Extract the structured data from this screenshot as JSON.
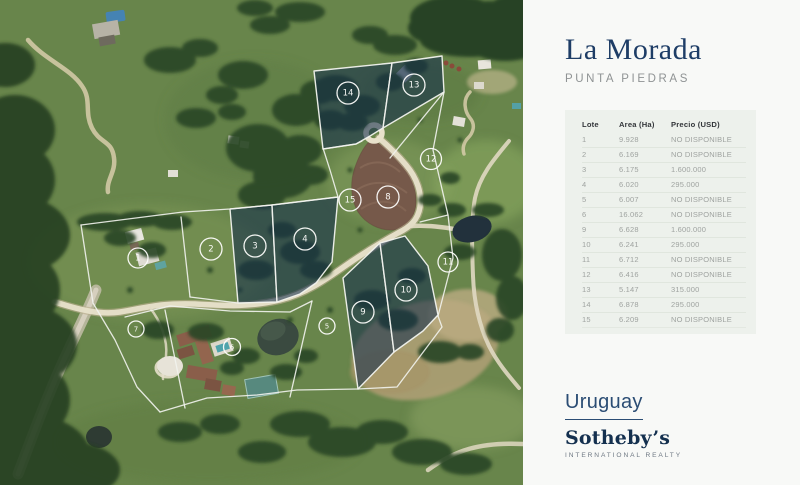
{
  "header": {
    "title": "La Morada",
    "subtitle": "PUNTA  PIEDRAS"
  },
  "table": {
    "columns": [
      "Lote",
      "Area (Ha)",
      "Precio (USD)"
    ],
    "rows": [
      [
        "1",
        "9.928",
        "NO DISPONIBLE"
      ],
      [
        "2",
        "6.169",
        "NO DISPONIBLE"
      ],
      [
        "3",
        "6.175",
        "1.600.000"
      ],
      [
        "4",
        "6.020",
        "295.000"
      ],
      [
        "5",
        "6.007",
        "NO DISPONIBLE"
      ],
      [
        "6",
        "16.062",
        "NO DISPONIBLE"
      ],
      [
        "9",
        "6.628",
        "1.600.000"
      ],
      [
        "10",
        "6.241",
        "295.000"
      ],
      [
        "11",
        "6.712",
        "NO DISPONIBLE"
      ],
      [
        "12",
        "6.416",
        "NO DISPONIBLE"
      ],
      [
        "13",
        "5.147",
        "315.000"
      ],
      [
        "14",
        "6.878",
        "295.000"
      ],
      [
        "15",
        "6.209",
        "NO DISPONIBLE"
      ]
    ]
  },
  "brand": {
    "country": "Uruguay",
    "name": "Sotheby’s",
    "tagline": "INTERNATIONAL REALTY"
  },
  "map": {
    "lots": [
      {
        "n": "1",
        "x": 138,
        "y": 258,
        "r": 10,
        "filled": false
      },
      {
        "n": "2",
        "x": 211,
        "y": 249,
        "r": 11,
        "filled": false
      },
      {
        "n": "3",
        "x": 255,
        "y": 246,
        "r": 11,
        "filled": true
      },
      {
        "n": "4",
        "x": 305,
        "y": 239,
        "r": 11,
        "filled": true
      },
      {
        "n": "5",
        "x": 327,
        "y": 326,
        "r": 8,
        "filled": false
      },
      {
        "n": "6",
        "x": 232,
        "y": 347,
        "r": 8.5,
        "filled": false
      },
      {
        "n": "7",
        "x": 136,
        "y": 329,
        "r": 8,
        "filled": false
      },
      {
        "n": "8",
        "x": 388,
        "y": 197,
        "r": 11,
        "filled": false
      },
      {
        "n": "9",
        "x": 363,
        "y": 312,
        "r": 11,
        "filled": true
      },
      {
        "n": "10",
        "x": 406,
        "y": 290,
        "r": 11,
        "filled": true
      },
      {
        "n": "11",
        "x": 448,
        "y": 262,
        "r": 10,
        "filled": false
      },
      {
        "n": "12",
        "x": 431,
        "y": 159,
        "r": 10.5,
        "filled": false
      },
      {
        "n": "13",
        "x": 414,
        "y": 85,
        "r": 11,
        "filled": true
      },
      {
        "n": "14",
        "x": 348,
        "y": 93,
        "r": 11,
        "filled": true
      },
      {
        "n": "15",
        "x": 350,
        "y": 200,
        "r": 11,
        "filled": false
      }
    ]
  },
  "colors": {
    "title_navy": "#1e3d66",
    "brand_navy": "#14304f",
    "table_bg": "#edf1ec",
    "lot_overlay": "rgba(20,46,76,0.58)",
    "boundary_line": "#f2f3ee"
  }
}
